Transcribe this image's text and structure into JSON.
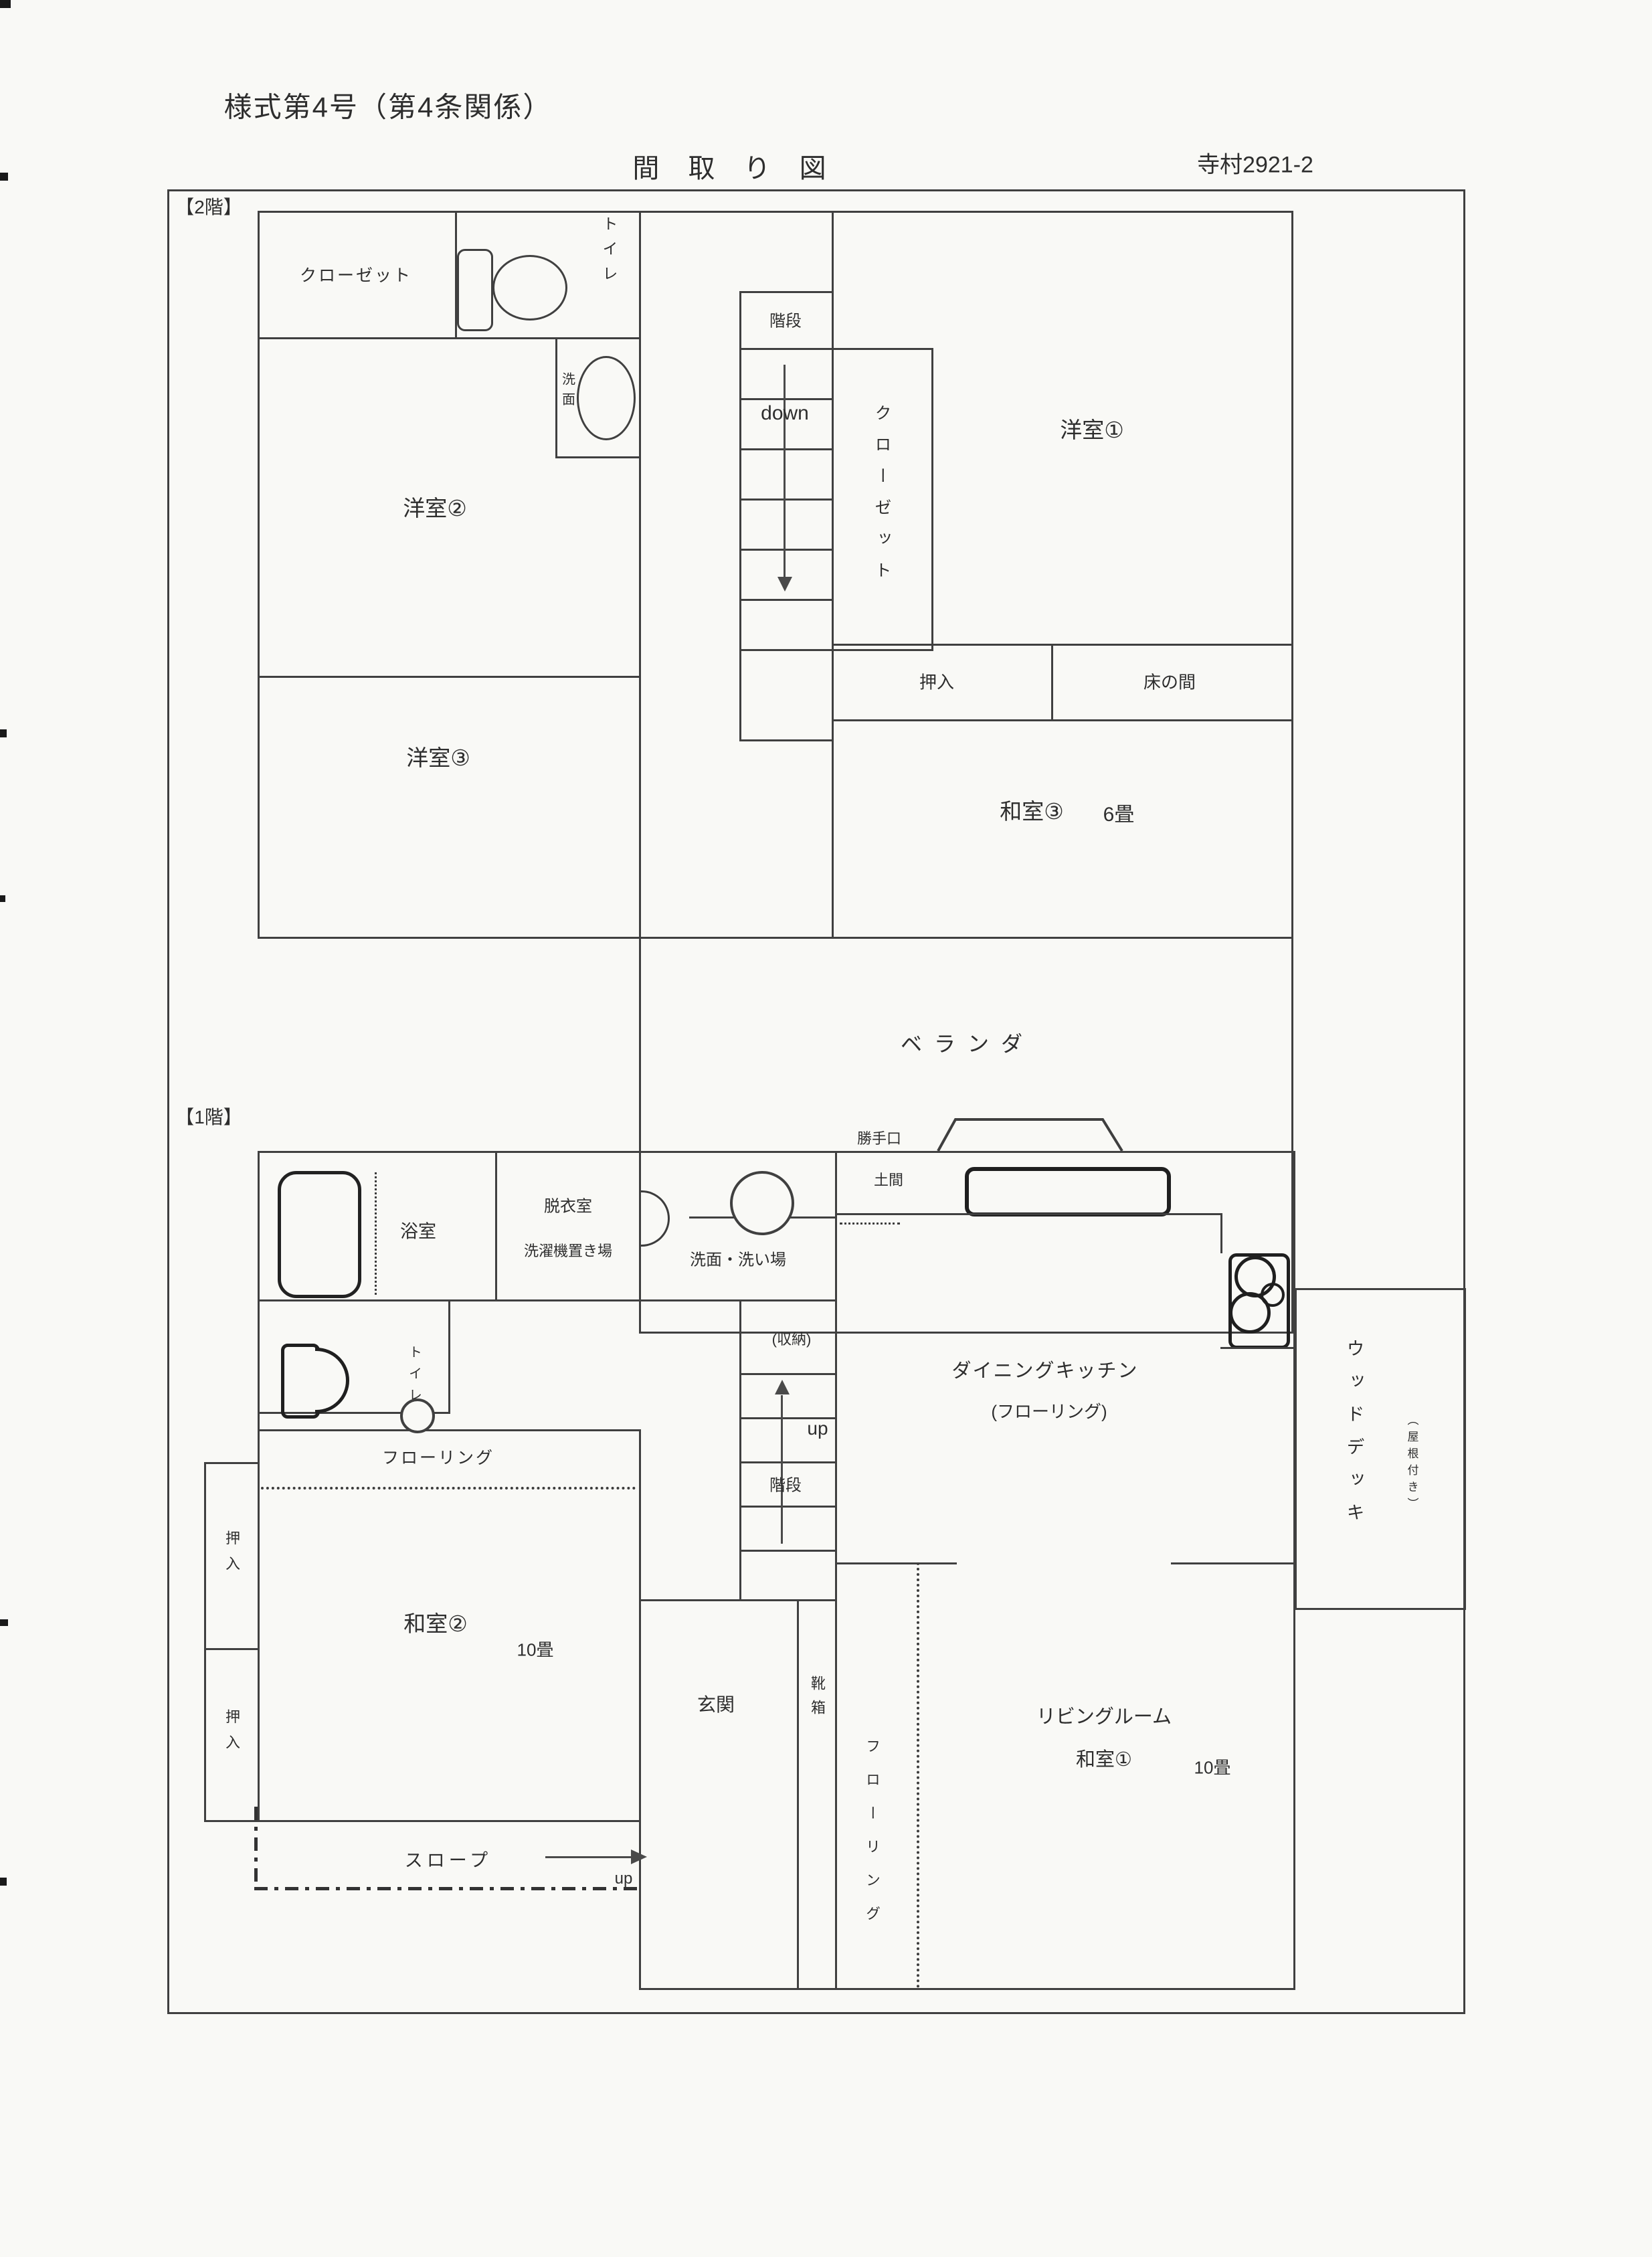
{
  "header": {
    "form_number": "様式第4号（第4条関係）",
    "title": "間 取 り 図",
    "lot_number": "寺村2921-2"
  },
  "floor2": {
    "section_label": "【2階】",
    "closet_top": "クローゼット",
    "toilet": "トイレ",
    "washstand": "洗面",
    "yoshitsu2": "洋室②",
    "yoshitsu3": "洋室③",
    "yoshitsu1": "洋室①",
    "stairs": "階段",
    "down": "down",
    "closet_vertical": "クローゼット",
    "oshiire": "押入",
    "tokonoma": "床の間",
    "washitsu3": "和室③",
    "washitsu3_size": "6畳",
    "veranda": "ベランダ"
  },
  "floor1": {
    "section_label": "【1階】",
    "bath": "浴室",
    "dressing_room": "脱衣室",
    "washer_space": "洗濯機置き場",
    "washroom": "洗面・洗い場",
    "katteguchi": "勝手口",
    "doma": "土間",
    "dk_line1": "ダイニングキッチン",
    "dk_line2": "(フローリング)",
    "wood_deck": "ウッドデッキ",
    "roofed_note": "（屋根付き）",
    "toilet": "トイレ",
    "storage": "(収納)",
    "stairs_up": "up",
    "stairs": "階段",
    "flooring_strip": "フローリング",
    "oshiire_top": "押入",
    "oshiire_bottom": "押入",
    "washitsu2": "和室②",
    "washitsu2_size": "10畳",
    "genkan": "玄関",
    "shoe_box": "靴箱",
    "flooring_vertical": "フローリング",
    "living_line1": "リビングルーム",
    "living_line2": "和室①",
    "living_size": "10畳",
    "slope": "スロープ",
    "slope_up": "up"
  },
  "icons": {
    "toilet_2f": "toilet-icon",
    "washbasin_2f": "washbasin-oval-icon",
    "bathtub_1f": "bathtub-icon",
    "door_swing": "door-arc-icon",
    "washbasin_1f": "washbasin-circle-icon",
    "toilet_1f": "toilet-icon",
    "kitchen_counter": "kitchen-counter-icon",
    "stove": "stove-burners-icon",
    "back_door": "back-door-trapezoid-icon",
    "down_arrow": "arrow-down-icon",
    "up_arrow": "arrow-up-icon",
    "slope_arrow": "arrow-right-icon"
  }
}
